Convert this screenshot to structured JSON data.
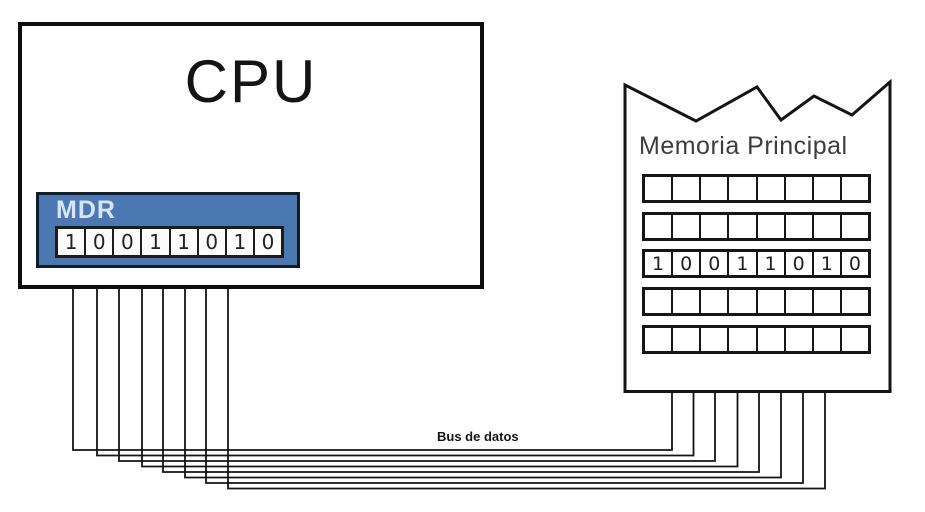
{
  "cpu": {
    "title": "CPU"
  },
  "mdr": {
    "label": "MDR",
    "bits": [
      "1",
      "0",
      "0",
      "1",
      "1",
      "0",
      "1",
      "0"
    ]
  },
  "memory": {
    "title": "Memoria Principal",
    "rows": [
      [
        "",
        "",
        "",
        "",
        "",
        "",
        "",
        ""
      ],
      [
        "",
        "",
        "",
        "",
        "",
        "",
        "",
        ""
      ],
      [
        "1",
        "0",
        "0",
        "1",
        "1",
        "0",
        "1",
        "0"
      ],
      [
        "",
        "",
        "",
        "",
        "",
        "",
        "",
        ""
      ],
      [
        "",
        "",
        "",
        "",
        "",
        "",
        "",
        ""
      ]
    ]
  },
  "bus": {
    "label": "Bus de datos",
    "line_count": 8
  },
  "colors": {
    "register_background": "#4c78b2",
    "register_border": "#121d29",
    "register_label_text": "#d6e4f4",
    "outline": "#141414"
  }
}
